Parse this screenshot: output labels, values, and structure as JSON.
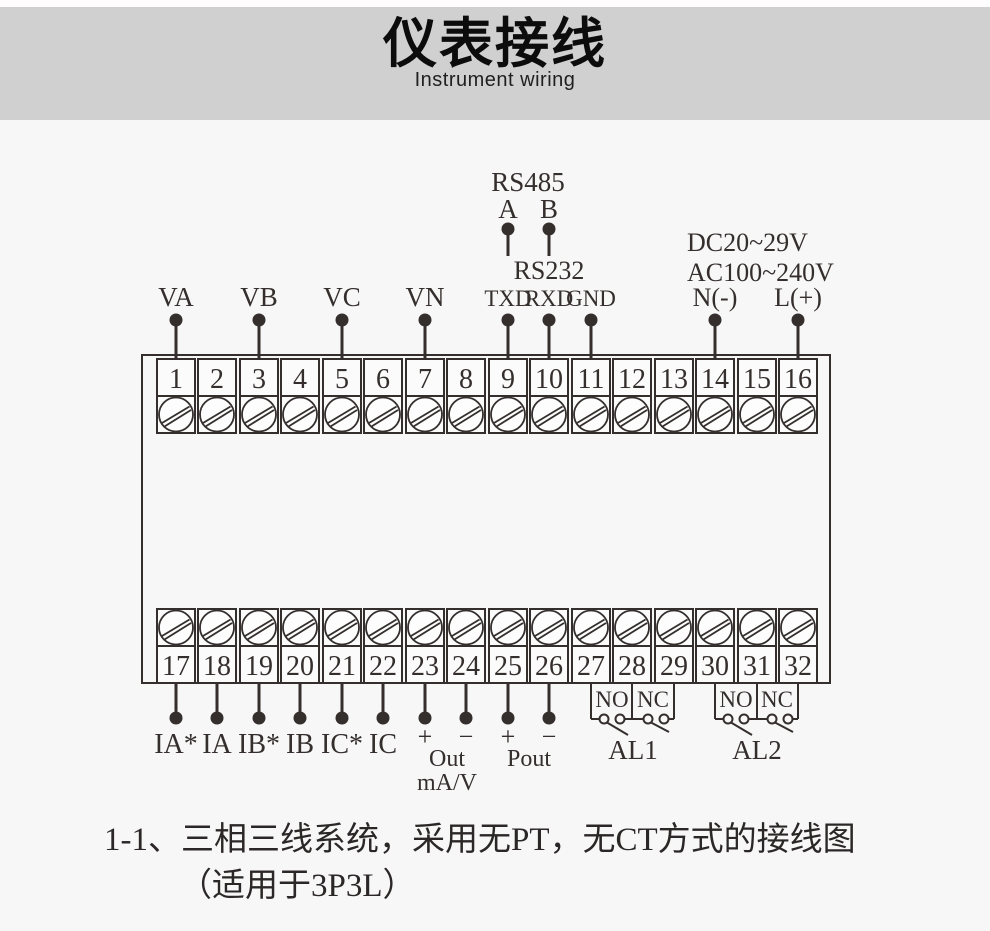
{
  "header": {
    "title": "仪表接线",
    "subtitle": "Instrument wiring"
  },
  "colors": {
    "header_band": "#d0d0d0",
    "page_background": "#f7f7f7",
    "line": "#342e2d"
  },
  "wiring": {
    "voltage_inputs": [
      "VA",
      "VB",
      "VC",
      "VN"
    ],
    "rs485": {
      "title": "RS485",
      "pin_a": "A",
      "pin_b": "B"
    },
    "rs232": {
      "title": "RS232",
      "txd": "TXD",
      "rxd": "RXD",
      "gnd": "GND"
    },
    "power_supply": {
      "dc": "DC20~29V",
      "ac": "AC100~240V",
      "neutral": "N(-)",
      "live": "L(+)"
    },
    "top_terminals": [
      "1",
      "2",
      "3",
      "4",
      "5",
      "6",
      "7",
      "8",
      "9",
      "10",
      "11",
      "12",
      "13",
      "14",
      "15",
      "16"
    ],
    "bottom_terminals": [
      "17",
      "18",
      "19",
      "20",
      "21",
      "22",
      "23",
      "24",
      "25",
      "26",
      "27",
      "28",
      "29",
      "30",
      "31",
      "32"
    ],
    "current_inputs": [
      "IA*",
      "IA",
      "IB*",
      "IB",
      "IC*",
      "IC"
    ],
    "analog_output": {
      "plus": "+",
      "minus": "−",
      "name": "Out",
      "unit": "mA/V"
    },
    "power_output": {
      "plus": "+",
      "minus": "−",
      "name": "Pout"
    },
    "alarm1": {
      "no": "NO",
      "nc": "NC",
      "name": "AL1"
    },
    "alarm2": {
      "no": "NO",
      "nc": "NC",
      "name": "AL2"
    }
  },
  "caption": {
    "line1": "1-1、三相三线系统，采用无PT，无CT方式的接线图",
    "line2": "（适用于3P3L）"
  }
}
